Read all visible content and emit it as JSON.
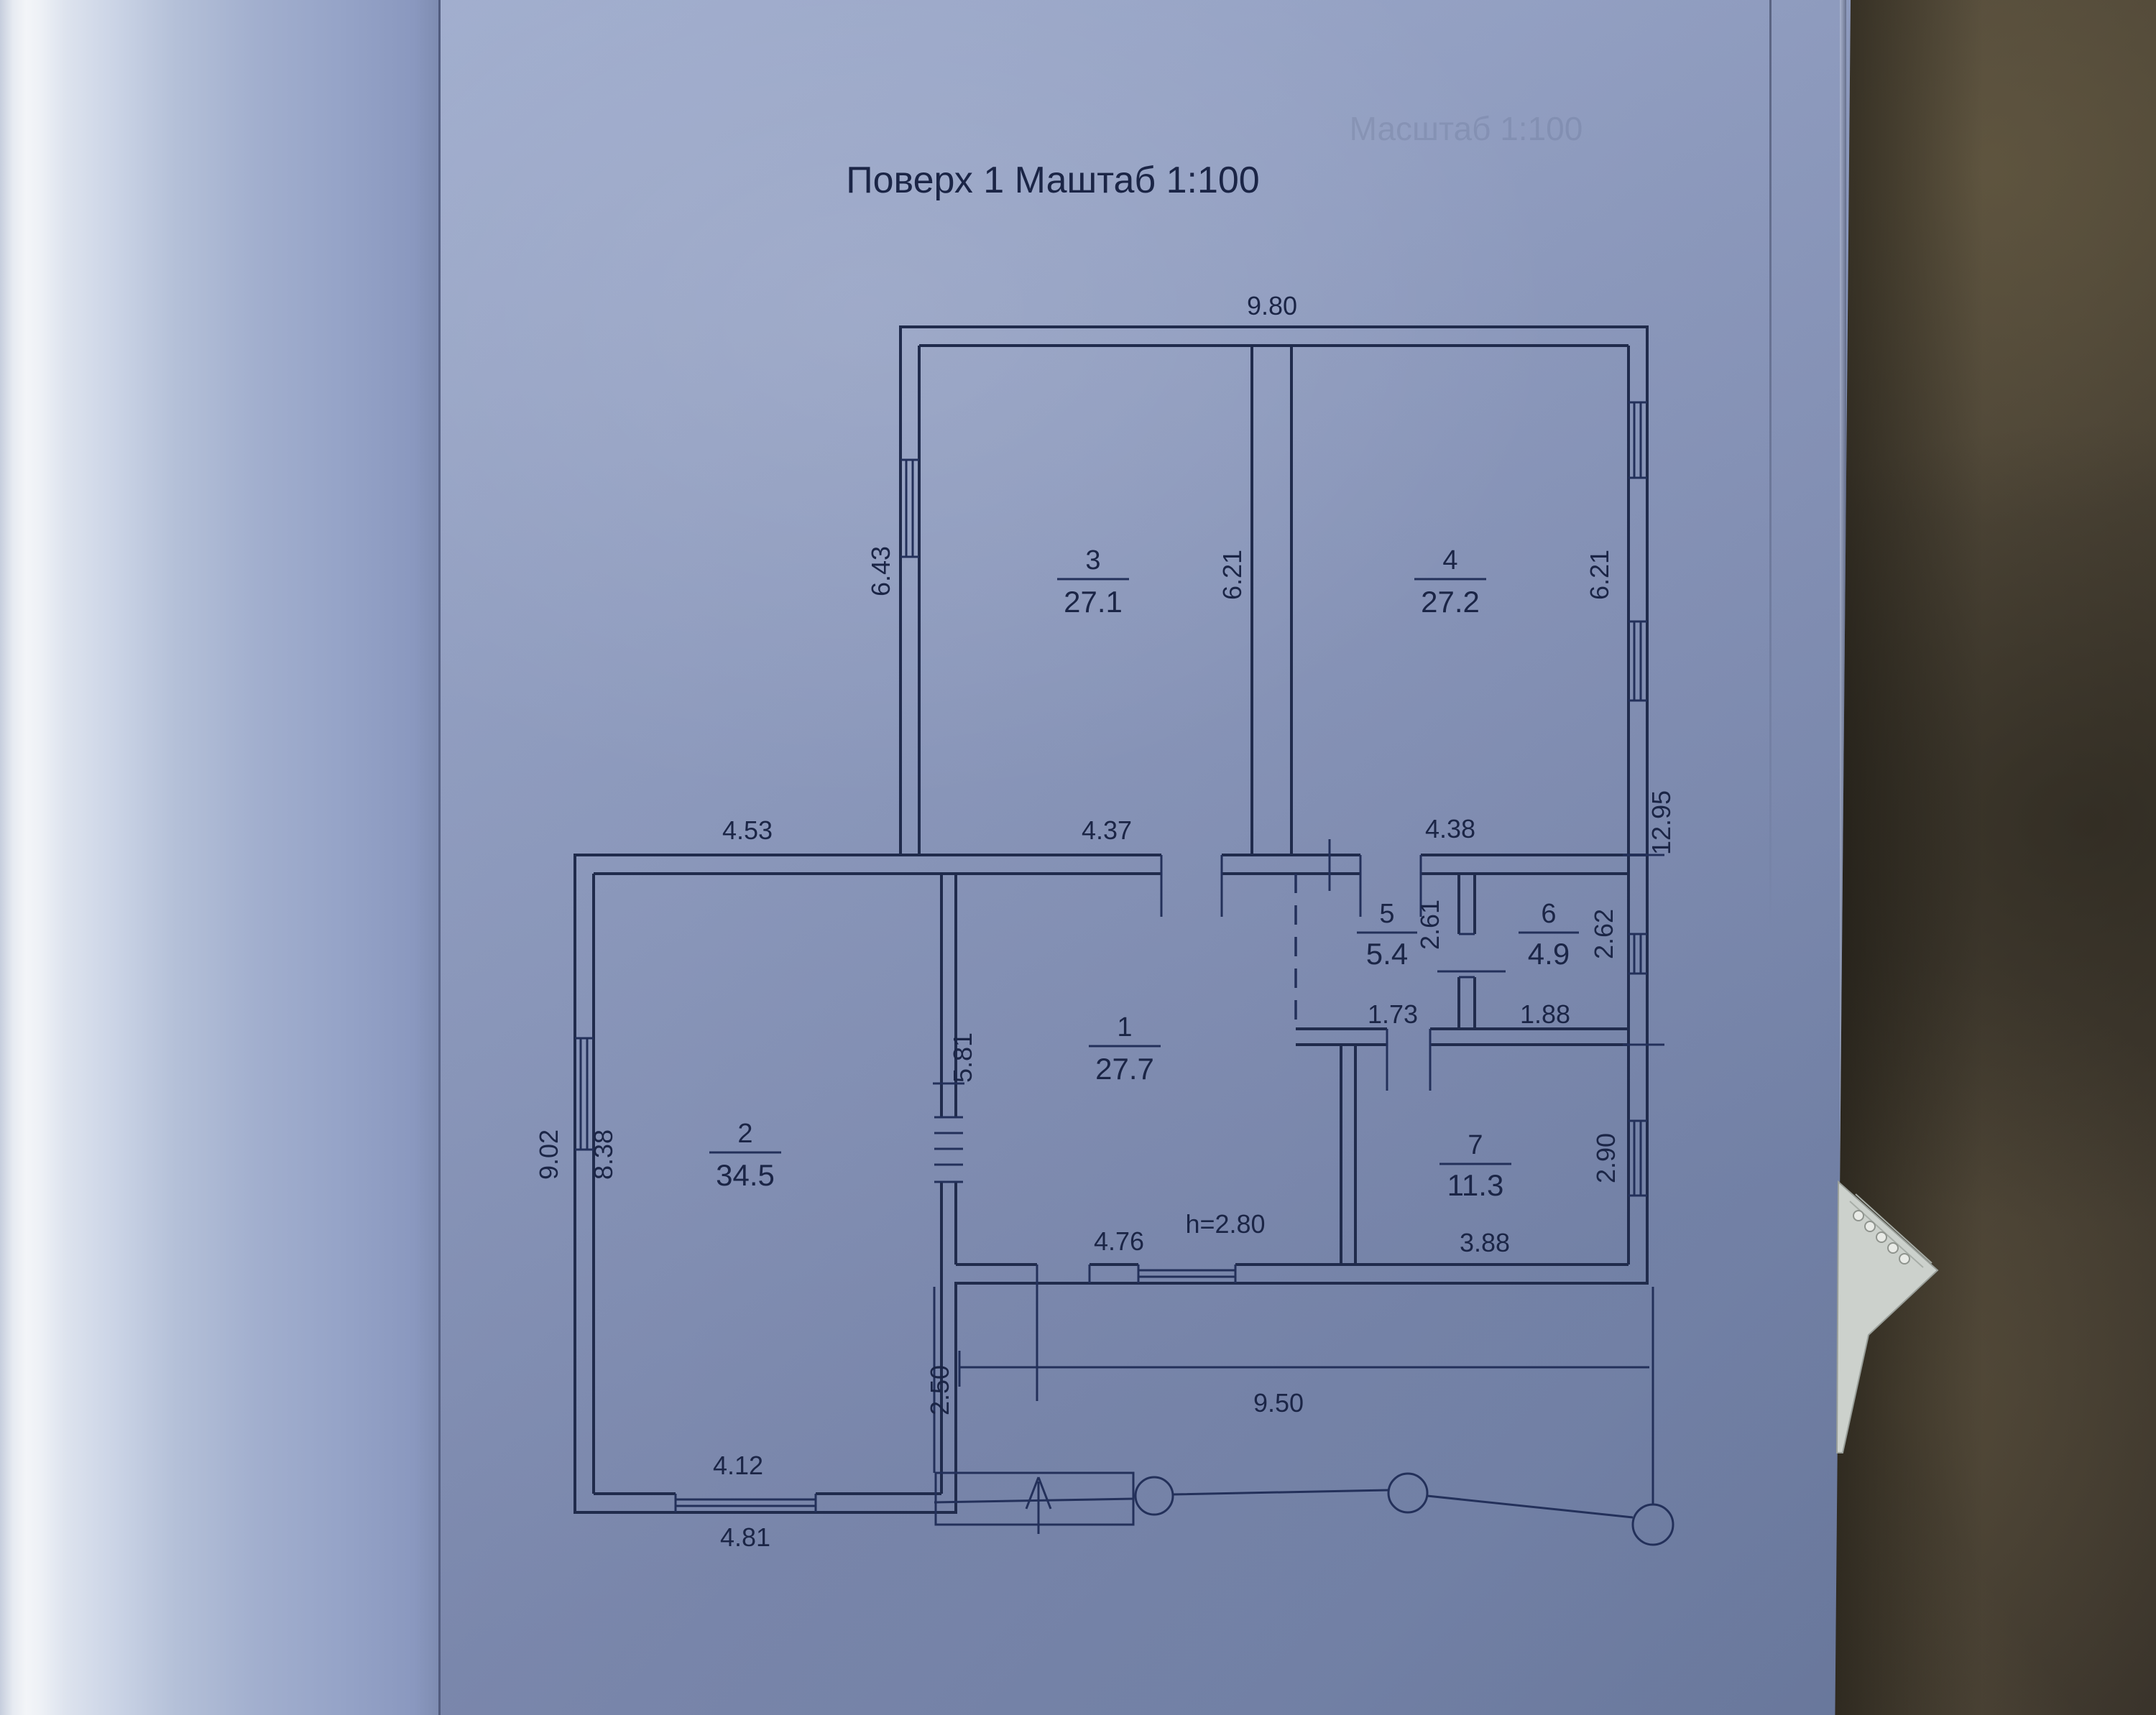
{
  "photo": {
    "paper_color": "#8c9bc1",
    "line_color": "#202b4c",
    "table_color": "#4b4336"
  },
  "plan": {
    "title": "Поверх 1 Маштаб 1:100",
    "bleed_text": "Масштаб 1:100",
    "note_height": "h=2.80",
    "rooms": [
      {
        "number": "1",
        "area": "27.7"
      },
      {
        "number": "2",
        "area": "34.5"
      },
      {
        "number": "3",
        "area": "27.1"
      },
      {
        "number": "4",
        "area": "27.2"
      },
      {
        "number": "5",
        "area": "5.4"
      },
      {
        "number": "6",
        "area": "4.9"
      },
      {
        "number": "7",
        "area": "11.3"
      }
    ],
    "dimensions": {
      "top_width": "9.80",
      "room3_left_height": "6.43",
      "room3_right_height": "6.21",
      "room4_right_height": "6.21",
      "room2_top_width": "4.53",
      "room3_bottom_width": "4.37",
      "room4_bottom_width": "4.38",
      "right_total_height": "12.95",
      "room5_height": "2.61",
      "room6_height": "2.62",
      "room5_bottom_width": "1.73",
      "room6_bottom_width": "1.88",
      "room1_left_height": "5.81",
      "room2_left_inner_height": "8.38",
      "room2_left_outer_height": "9.02",
      "room7_right_height": "2.90",
      "room1_bottom_width": "4.76",
      "room7_bottom_width": "3.88",
      "bottom_total_width": "9.50",
      "porch_depth": "2.50",
      "room2_bottom_inner_width": "4.12",
      "room2_bottom_outer_width": "4.81"
    }
  }
}
